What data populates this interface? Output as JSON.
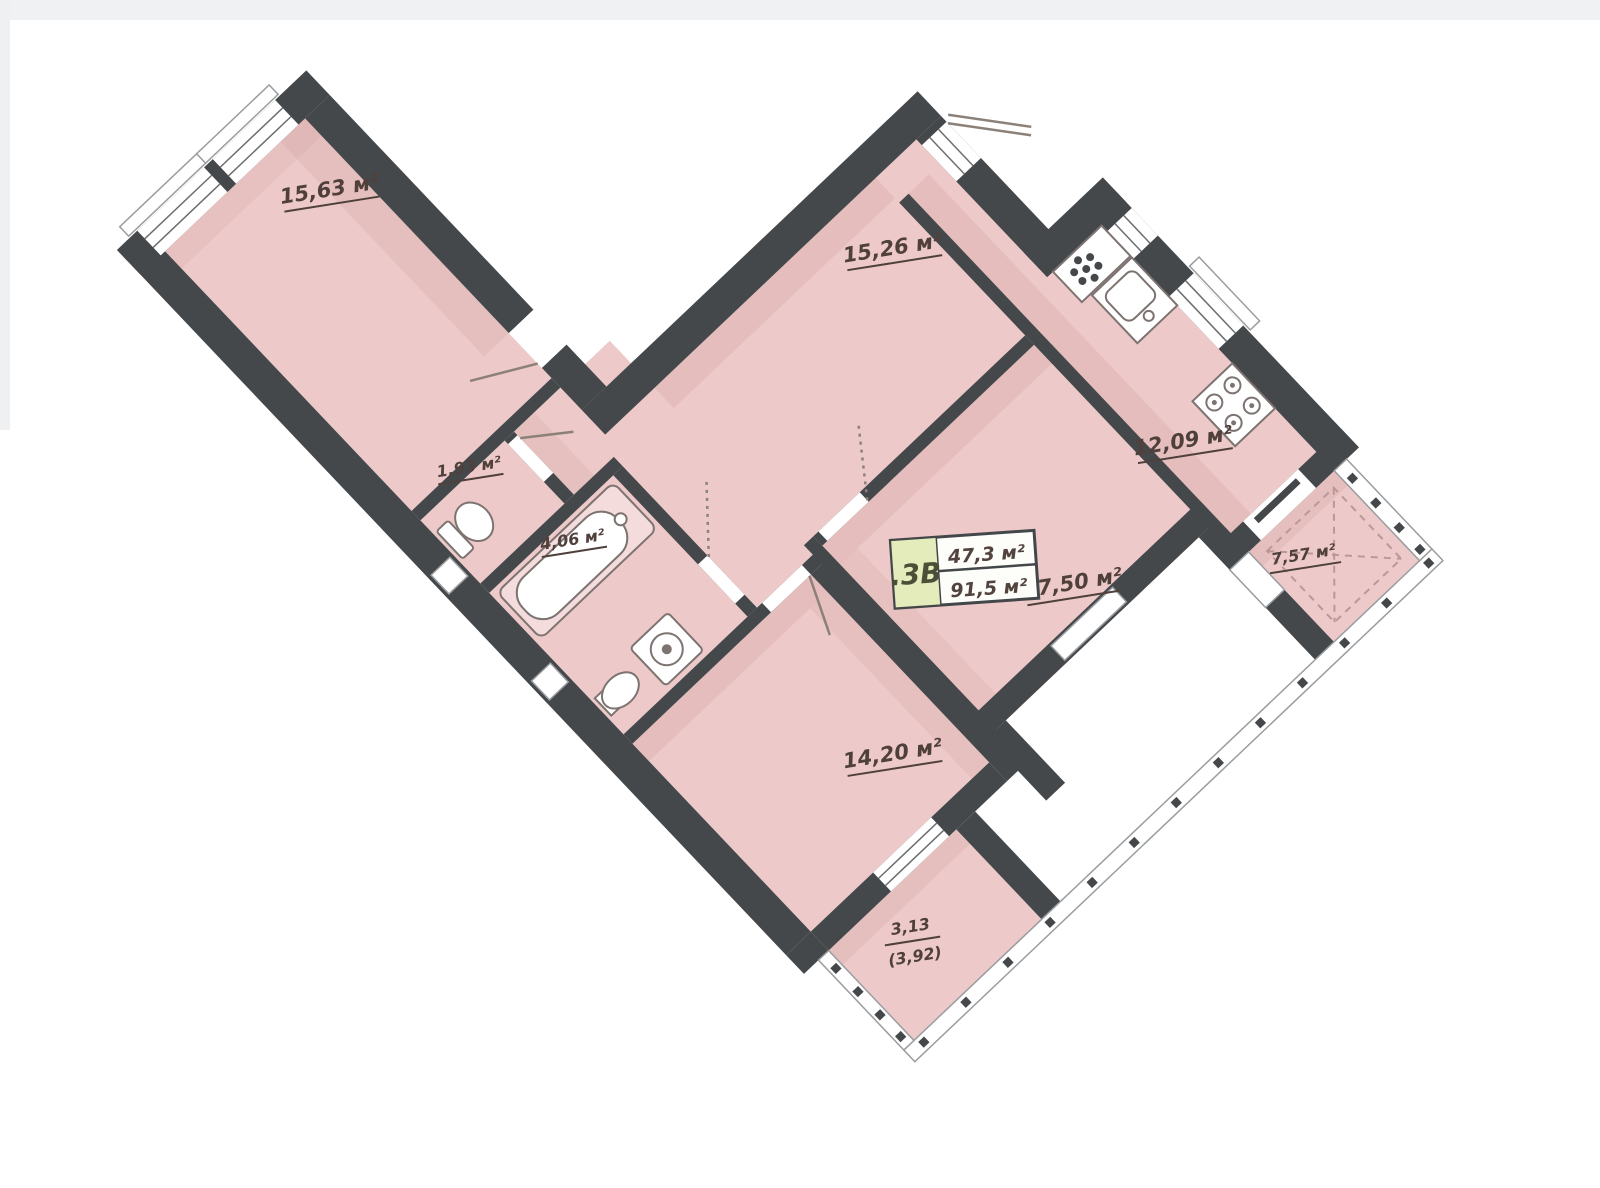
{
  "plan": {
    "title": "apartment floor plan",
    "unit_badge": {
      "code": ".3В",
      "area_living": "47,3 м²",
      "area_total": "91,5 м²"
    },
    "rooms": [
      {
        "id": "bedroom",
        "label": "15,63 м²"
      },
      {
        "id": "hall",
        "label": "15,26 м²"
      },
      {
        "id": "wc",
        "label": "1,93 м²"
      },
      {
        "id": "bathroom",
        "label": "4,06 м²"
      },
      {
        "id": "kitchen",
        "label": "12,09 м²"
      },
      {
        "id": "living-room",
        "label": "17,50 м²"
      },
      {
        "id": "room-bottom",
        "label": "14,20 м²"
      },
      {
        "id": "balcony-right",
        "label": "7,57 м²"
      },
      {
        "id": "balcony-bottom",
        "label_area": "3,13",
        "label_total": "(3,92)"
      }
    ],
    "colors": {
      "wall": "#45484b",
      "floor": "#edcac9",
      "badge_green": "#e3ecba",
      "label_text": "#4f403c",
      "background": "#ffffff"
    }
  }
}
